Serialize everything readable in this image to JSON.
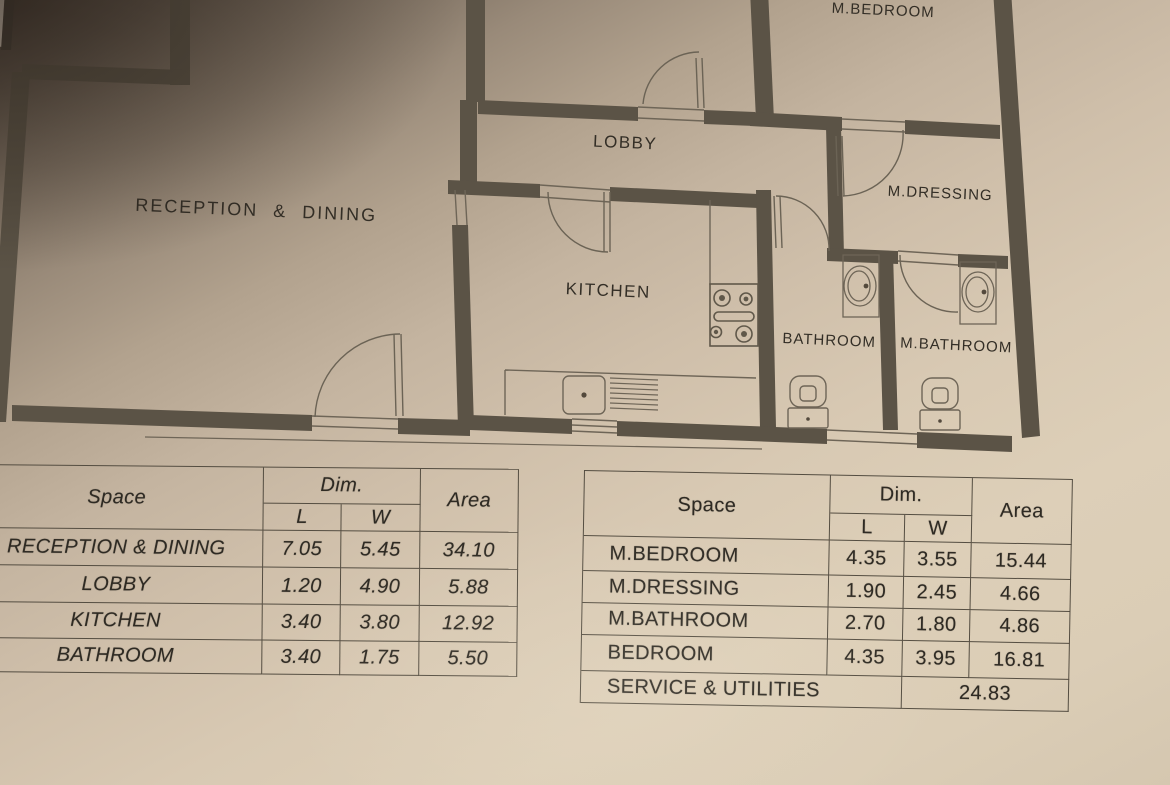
{
  "plan": {
    "rooms": {
      "reception": "RECEPTION & DINING",
      "lobby": "LOBBY",
      "kitchen": "KITCHEN",
      "bathroom": "BATHROOM",
      "m_bathroom": "M.BATHROOM",
      "m_dressing": "M.DRESSING",
      "m_bedroom": "M.BEDROOM"
    }
  },
  "tables": {
    "left": {
      "headers": {
        "space": "Space",
        "dim": "Dim.",
        "l": "L",
        "w": "W",
        "area": "Area"
      },
      "rows": [
        {
          "space": "RECEPTION & DINING",
          "l": "7.05",
          "w": "5.45",
          "area": "34.10"
        },
        {
          "space": "LOBBY",
          "l": "1.20",
          "w": "4.90",
          "area": "5.88"
        },
        {
          "space": "KITCHEN",
          "l": "3.40",
          "w": "3.80",
          "area": "12.92"
        },
        {
          "space": "BATHROOM",
          "l": "3.40",
          "w": "1.75",
          "area": "5.50"
        }
      ]
    },
    "right": {
      "headers": {
        "space": "Space",
        "dim": "Dim.",
        "l": "L",
        "w": "W",
        "area": "Area"
      },
      "rows": [
        {
          "space": "M.BEDROOM",
          "l": "4.35",
          "w": "3.55",
          "area": "15.44"
        },
        {
          "space": "M.DRESSING",
          "l": "1.90",
          "w": "2.45",
          "area": "4.66"
        },
        {
          "space": "M.BATHROOM",
          "l": "2.70",
          "w": "1.80",
          "area": "4.86"
        },
        {
          "space": "BEDROOM",
          "l": "4.35",
          "w": "3.95",
          "area": "16.81"
        }
      ],
      "summary": {
        "label": "SERVICE & UTILITIES",
        "area": "24.83"
      }
    }
  }
}
